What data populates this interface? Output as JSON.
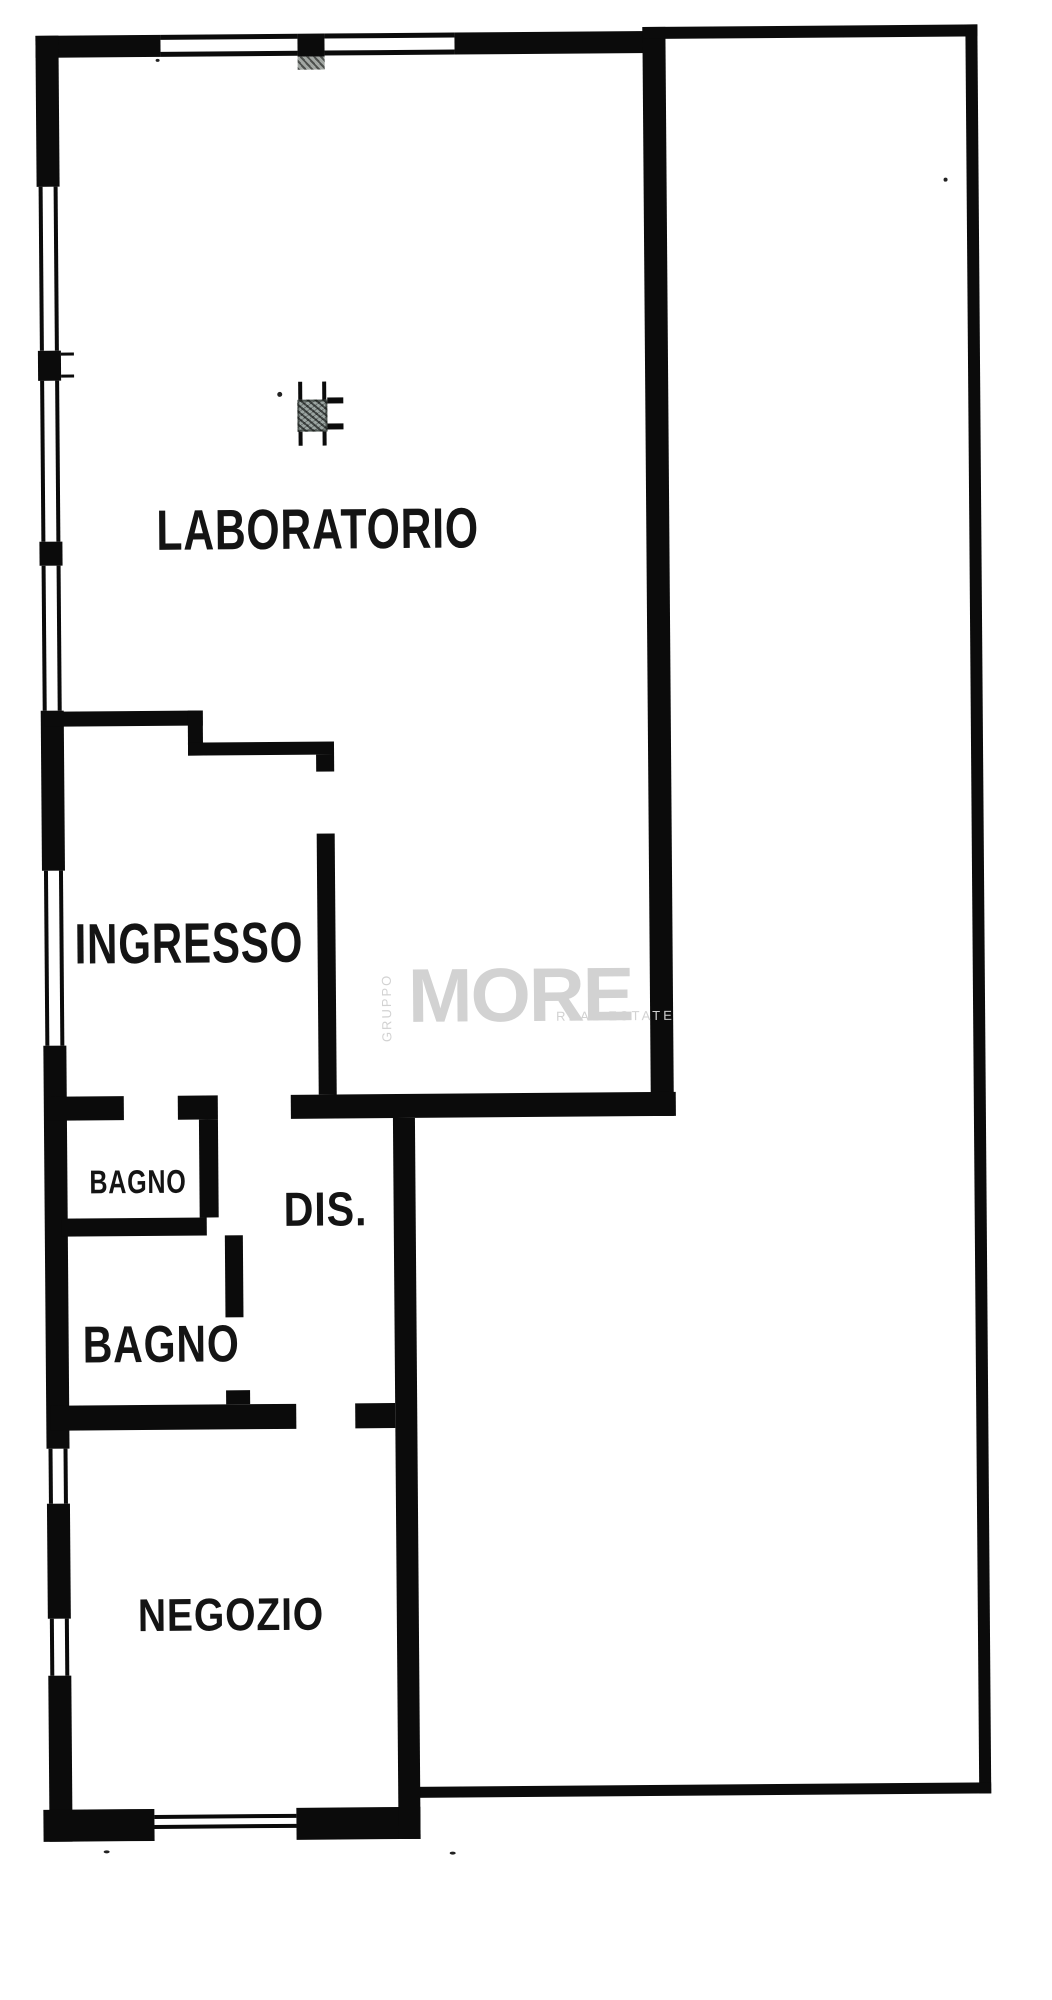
{
  "page": {
    "background": "#ffffff",
    "wall_color": "#0b0b0b",
    "label_color": "#141414"
  },
  "floorplan": {
    "rooms": [
      {
        "id": "laboratorio",
        "label": "LABORATORIO"
      },
      {
        "id": "ingresso",
        "label": "INGRESSO"
      },
      {
        "id": "bagno_small",
        "label": "BAGNO"
      },
      {
        "id": "dis",
        "label": "DIS."
      },
      {
        "id": "bagno_large",
        "label": "BAGNO"
      },
      {
        "id": "negozio",
        "label": "NEGOZIO"
      }
    ],
    "features": [
      "window-opening",
      "door-opening",
      "structural-column",
      "pier-hatch"
    ],
    "watermark": {
      "vertical_text": "GRUPPO",
      "brand": "MORE",
      "tagline": "REAL ESTATE",
      "color": "#d2d2d2"
    }
  }
}
